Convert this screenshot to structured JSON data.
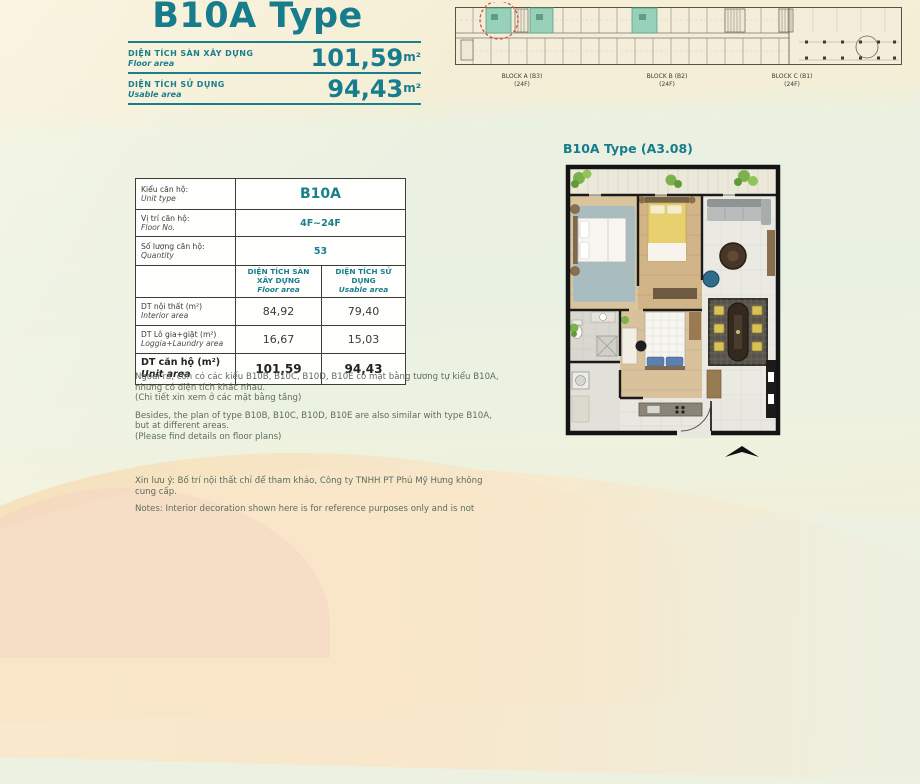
{
  "header": {
    "title": "B10A Type",
    "area_rows": [
      {
        "label_vi": "DIỆN TÍCH SÀN XÂY DỰNG",
        "label_en": "Floor area",
        "value": "101,59",
        "unit": "m²"
      },
      {
        "label_vi": "DIỆN TÍCH SỬ DỤNG",
        "label_en": "Usable area",
        "value": "94,43",
        "unit": "m²"
      }
    ]
  },
  "building_overview": {
    "blocks": [
      {
        "name": "BLOCK A (B3)",
        "floors": "(24F)"
      },
      {
        "name": "BLOCK B (B2)",
        "floors": "(24F)"
      },
      {
        "name": "BLOCK C (B1)",
        "floors": "(24F)"
      }
    ]
  },
  "unit_table": {
    "info_rows": [
      {
        "label_vi": "Kiểu căn hộ:",
        "label_en": "Unit type",
        "value": "B10A"
      },
      {
        "label_vi": "Vị trí căn hộ:",
        "label_en": "Floor No.",
        "value": "4F~24F"
      },
      {
        "label_vi": "Số lượng căn hộ:",
        "label_en": "Quantity",
        "value": "53"
      }
    ],
    "col_headers": [
      {
        "vi": "DIỆN TÍCH SÀN XÂY DỰNG",
        "en": "Floor area"
      },
      {
        "vi": "DIỆN TÍCH SỬ DỤNG",
        "en": "Usable area"
      }
    ],
    "area_rows": [
      {
        "label_vi": "DT nội thất  (m²)",
        "label_en": "Interior area",
        "floor": "84,92",
        "usable": "79,40"
      },
      {
        "label_vi": "DT Lô gia+giặt  (m²)",
        "label_en": "Loggia+Laundry area",
        "floor": "16,67",
        "usable": "15,03"
      },
      {
        "label_vi": "DT căn hộ (m²)",
        "label_en": "Unit area",
        "floor": "101,59",
        "usable": "94,43"
      }
    ]
  },
  "notes": {
    "para_vi": "Ngoài ra, còn có các kiểu B10B, B10C, B10D, B10E có mặt bằng tương tự kiểu B10A,\nnhưng có diện tích khác nhau.\n(Chi tiết xin xem ở các mặt bằng tầng)",
    "para_en": "Besides, the plan of type B10B, B10C, B10D, B10E are also similar with type B10A,\nbut at different areas.\n(Please find details on floor plans)",
    "note_vi": "Xin lưu ý: Bố trí nội thất chỉ để tham khảo, Công ty TNHH PT Phú Mỹ Hưng không\ncung cấp.",
    "note_en": "Notes: Interior decoration shown here is for reference purposes only and is not"
  },
  "floor_plan": {
    "label": "B10A Type (A3.08)"
  },
  "colors": {
    "accent_teal": "#1a7f8d",
    "body_text": "#5d6c60",
    "bg_cream": "#f6efd6",
    "bg_mint": "#e9f1e3",
    "bg_peach": "#f6dcb4",
    "highlight_unit": "#98d0ba",
    "highlight_circle_red": "#d9503c"
  }
}
